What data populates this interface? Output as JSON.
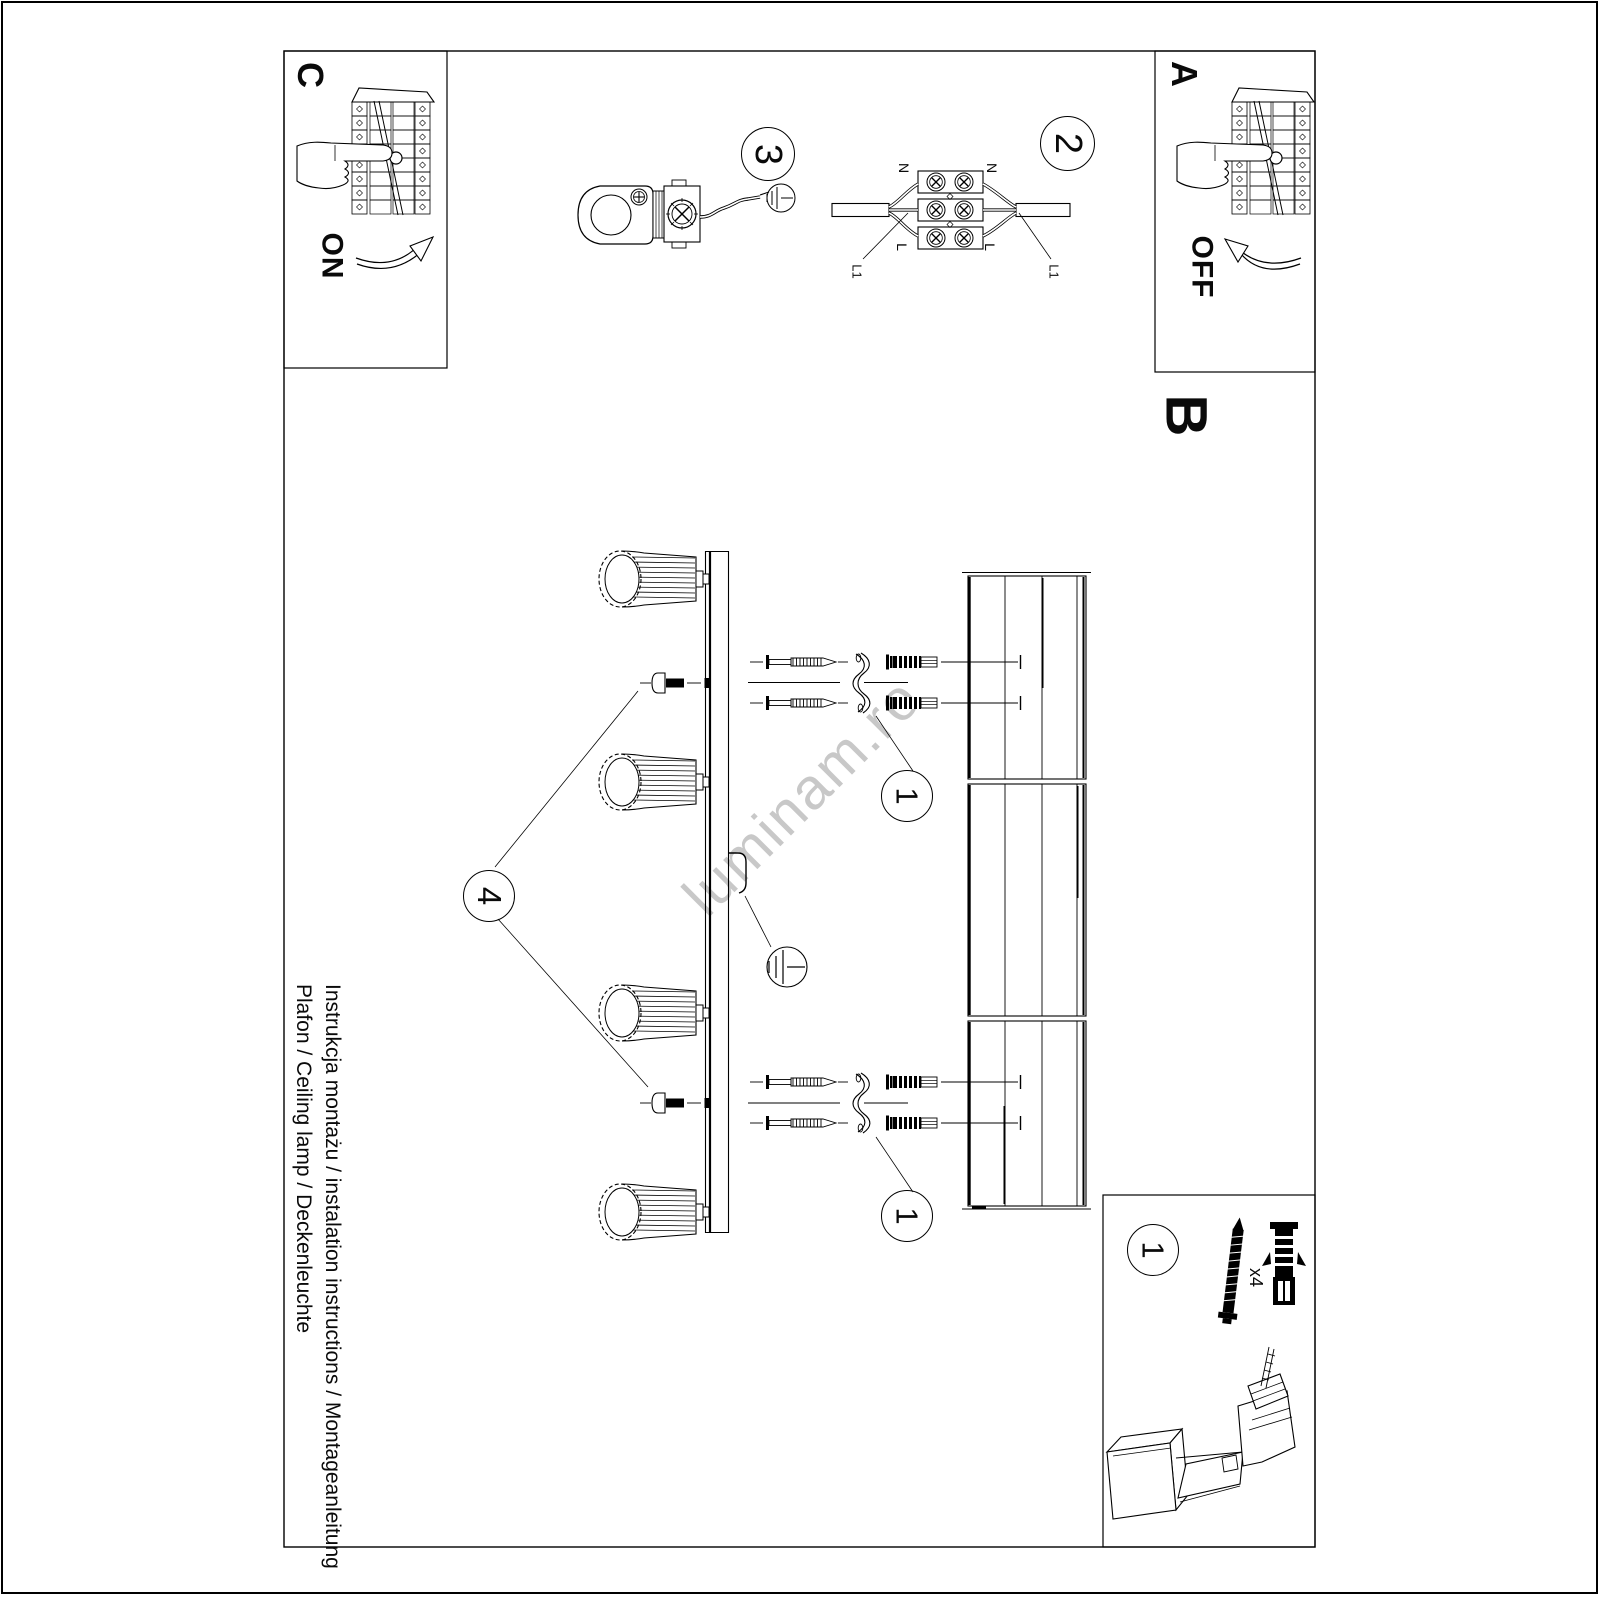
{
  "page": {
    "watermark": "luminam.ro",
    "footer": {
      "line1": "Instrukcja montażu / instalation instructions / Montageanleitung",
      "line2": "Plafon / Ceiling lamp / Deckenleuchte"
    }
  },
  "sections": {
    "power_on_box": {
      "label": "C",
      "state": "ON"
    },
    "power_off_box": {
      "label": "A",
      "state": "OFF"
    },
    "assembly_section": {
      "label": "B"
    }
  },
  "steps": {
    "step1": "1",
    "step2": "2",
    "step3": "3",
    "step4": "4"
  },
  "wiring_labels": {
    "neutral": "N",
    "live": "L",
    "line1": "L1"
  },
  "hardware": {
    "kit_step": "1",
    "screw_plug_qty": "x4"
  },
  "colors": {
    "line": "#000000",
    "watermark": "#c8c8c8"
  }
}
